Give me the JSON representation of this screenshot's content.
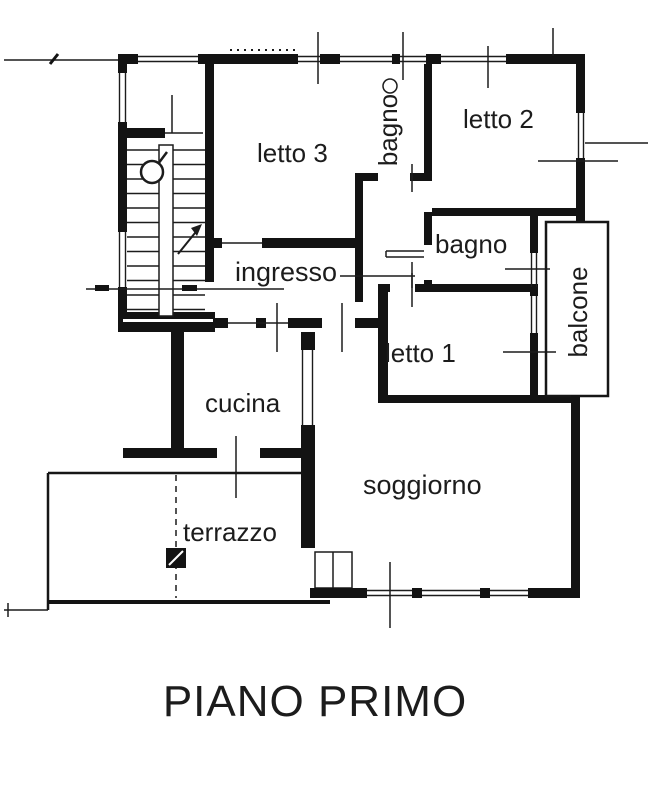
{
  "plan": {
    "title": "PIANO PRIMO",
    "type_label": "floor plan"
  },
  "rooms": {
    "letto3": {
      "label": "letto 3"
    },
    "bagno_top": {
      "label": "bagno"
    },
    "letto2": {
      "label": "letto 2"
    },
    "bagno_mid": {
      "label": "bagno"
    },
    "ingresso": {
      "label": "ingresso"
    },
    "balcone": {
      "label": "balcone"
    },
    "letto1": {
      "label": "letto 1"
    },
    "cucina": {
      "label": "cucina"
    },
    "soggiorno": {
      "label": "soggiorno"
    },
    "terrazzo": {
      "label": "terrazzo"
    }
  },
  "colors": {
    "wall": "#131313",
    "line": "#1c1c1c",
    "text": "#1c1c1c",
    "background": "#ffffff"
  }
}
